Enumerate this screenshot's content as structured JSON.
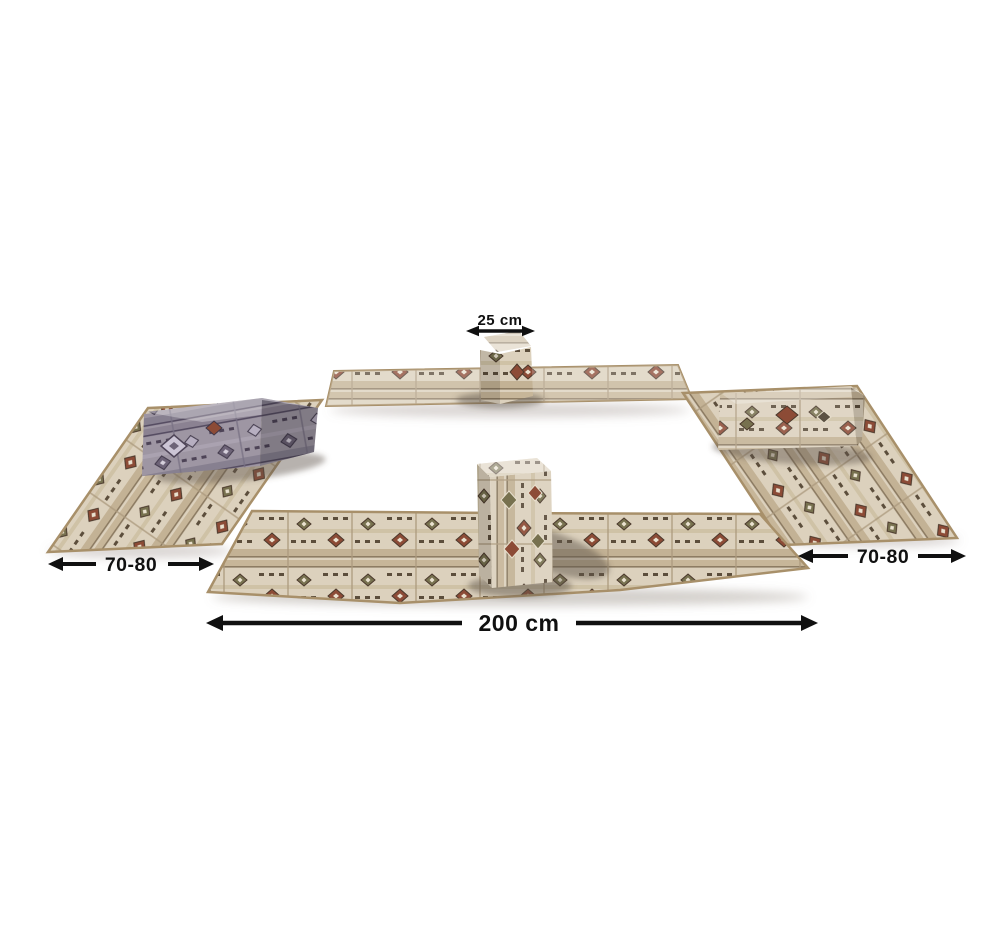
{
  "colors": {
    "background": "#ffffff",
    "label": "#101010",
    "fabric_beige": "#dcd1bd",
    "fabric_band": "#c7b699",
    "fabric_edge": "#a8906a",
    "accent_red": "#8c4b36",
    "accent_olive": "#77714f",
    "accent_dark": "#5c4e3c",
    "cushion_gray": "#9e96a3"
  },
  "annotations": {
    "cushion_width": {
      "label": "25 cm"
    },
    "left_mat_width": {
      "label": "70-80"
    },
    "right_mat_width": {
      "label": "70-80"
    },
    "mat_length": {
      "label": "200 cm"
    }
  }
}
